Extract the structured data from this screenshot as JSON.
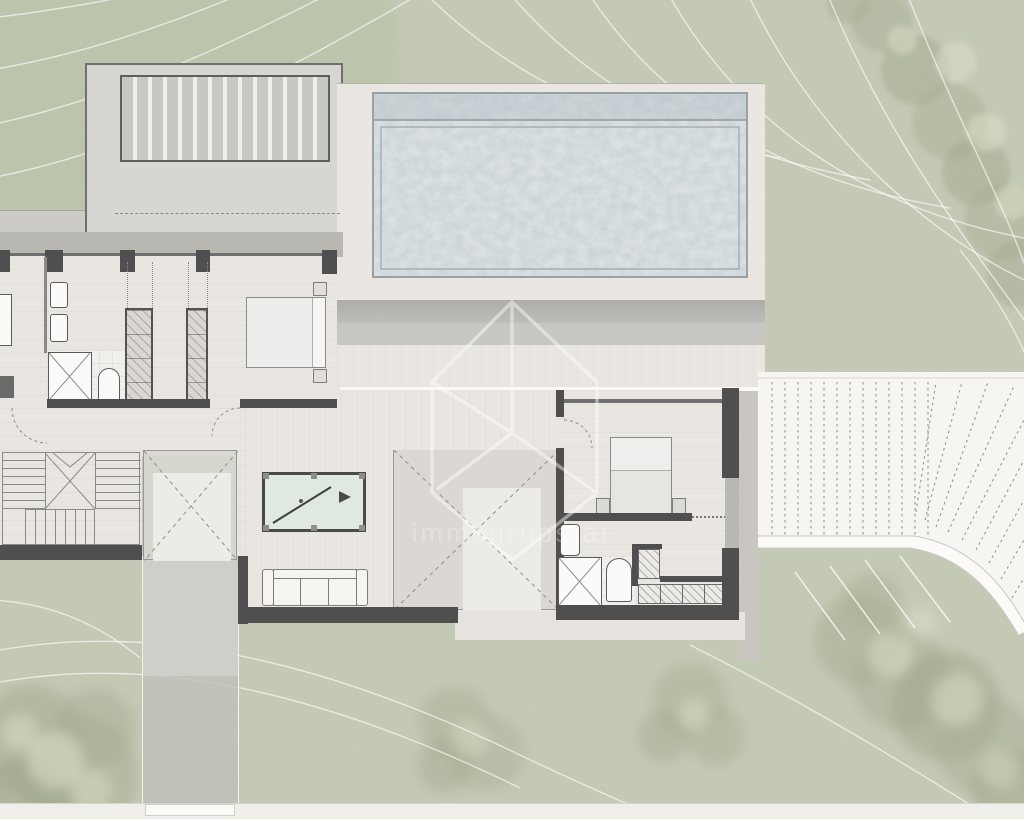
{
  "watermark": {
    "brand": "immogrupstar",
    "icon": "house-outline-icon"
  },
  "palette": {
    "grass": "#c6cbb7",
    "grassDark": "#b7c0a4",
    "treeOlive": "#a8ad93",
    "treeCream": "#e0dfc9",
    "contour": "#ffffff",
    "paper": "#f0eee8",
    "terrace": "#d8d6d2",
    "terraceBand": "#b9b7b2",
    "walk": "#cdcbc6",
    "deck": "#eae7e2",
    "deckSlatDark": "#c9c7c3",
    "deckSlatLight": "#f0eeeb",
    "water": "#c7d0d4",
    "waterRim": "#9aa2a5",
    "wall": "#4f4f4f",
    "wallLight": "#6f6f6f",
    "floor": "#e9e6e2",
    "tile": "#f1efeb",
    "closet": "#dad7d2",
    "voidInner": "#ecebe7",
    "felt": "#dfe9df",
    "frame": "#4a4a4a",
    "bridge": "#f6f5f1",
    "dot": "#8d8d88",
    "drive": "#c1bfbb",
    "watermark": "rgba(250,250,250,0.5)"
  },
  "scene": {
    "type": "architectural-floor-plan",
    "elements": [
      "garden-terrain",
      "contour-lines",
      "trees",
      "wood-deck-terrace",
      "swimming-pool",
      "pool-deck",
      "covered-terrace-steps",
      "bathroom-1",
      "walk-in-closets",
      "bedroom-1",
      "hallway",
      "staircase",
      "skylight-void",
      "billiard-table",
      "sofa",
      "double-height-void",
      "bedroom-2",
      "bathroom-2",
      "stepped-closet",
      "timber-bridge-driveway",
      "curved-road",
      "driveway-strip",
      "parking-markings",
      "page-margin"
    ]
  }
}
